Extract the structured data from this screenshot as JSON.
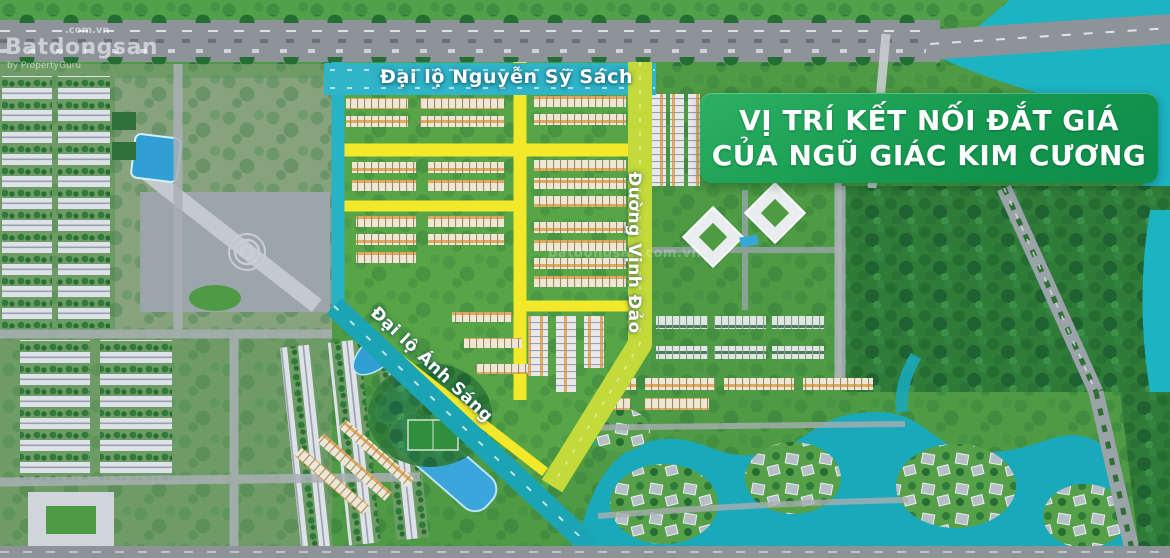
{
  "watermark": {
    "brand": "Batdongsan",
    "domain": ".com.vn",
    "byline": "by PropertyGuru",
    "center": "batdongsan.com.vn"
  },
  "banner": {
    "line1": "VỊ TRÍ KẾT NỐI ĐẮT GIÁ",
    "line2": "CỦA NGŨ GIÁC KIM CƯƠNG",
    "background": "#14984f",
    "text_color": "#ffffff"
  },
  "road_labels": [
    {
      "id": "dai-lo-nguyen-sy-sach",
      "text": "Đại lộ Nguyễn Sỹ Sách",
      "orientation": "horizontal",
      "road_color": "#2fb4c8"
    },
    {
      "id": "duong-vinh-dao",
      "text": "Đường Vịnh Đảo",
      "orientation": "vertical",
      "road_color": "#c3da3a"
    },
    {
      "id": "dai-lo-anh-sang",
      "text": "Đại lộ Ánh Sáng",
      "orientation": "diagonal",
      "road_color": "#1ba4b4"
    }
  ],
  "map": {
    "description": "Aerial masterplan rendering of a residential development with a highlighted pentagon-shaped parcel",
    "highlight_road_color": "#f3e92a",
    "water_color": "#1cb3c3",
    "landscape_color": "#4e9a45"
  }
}
